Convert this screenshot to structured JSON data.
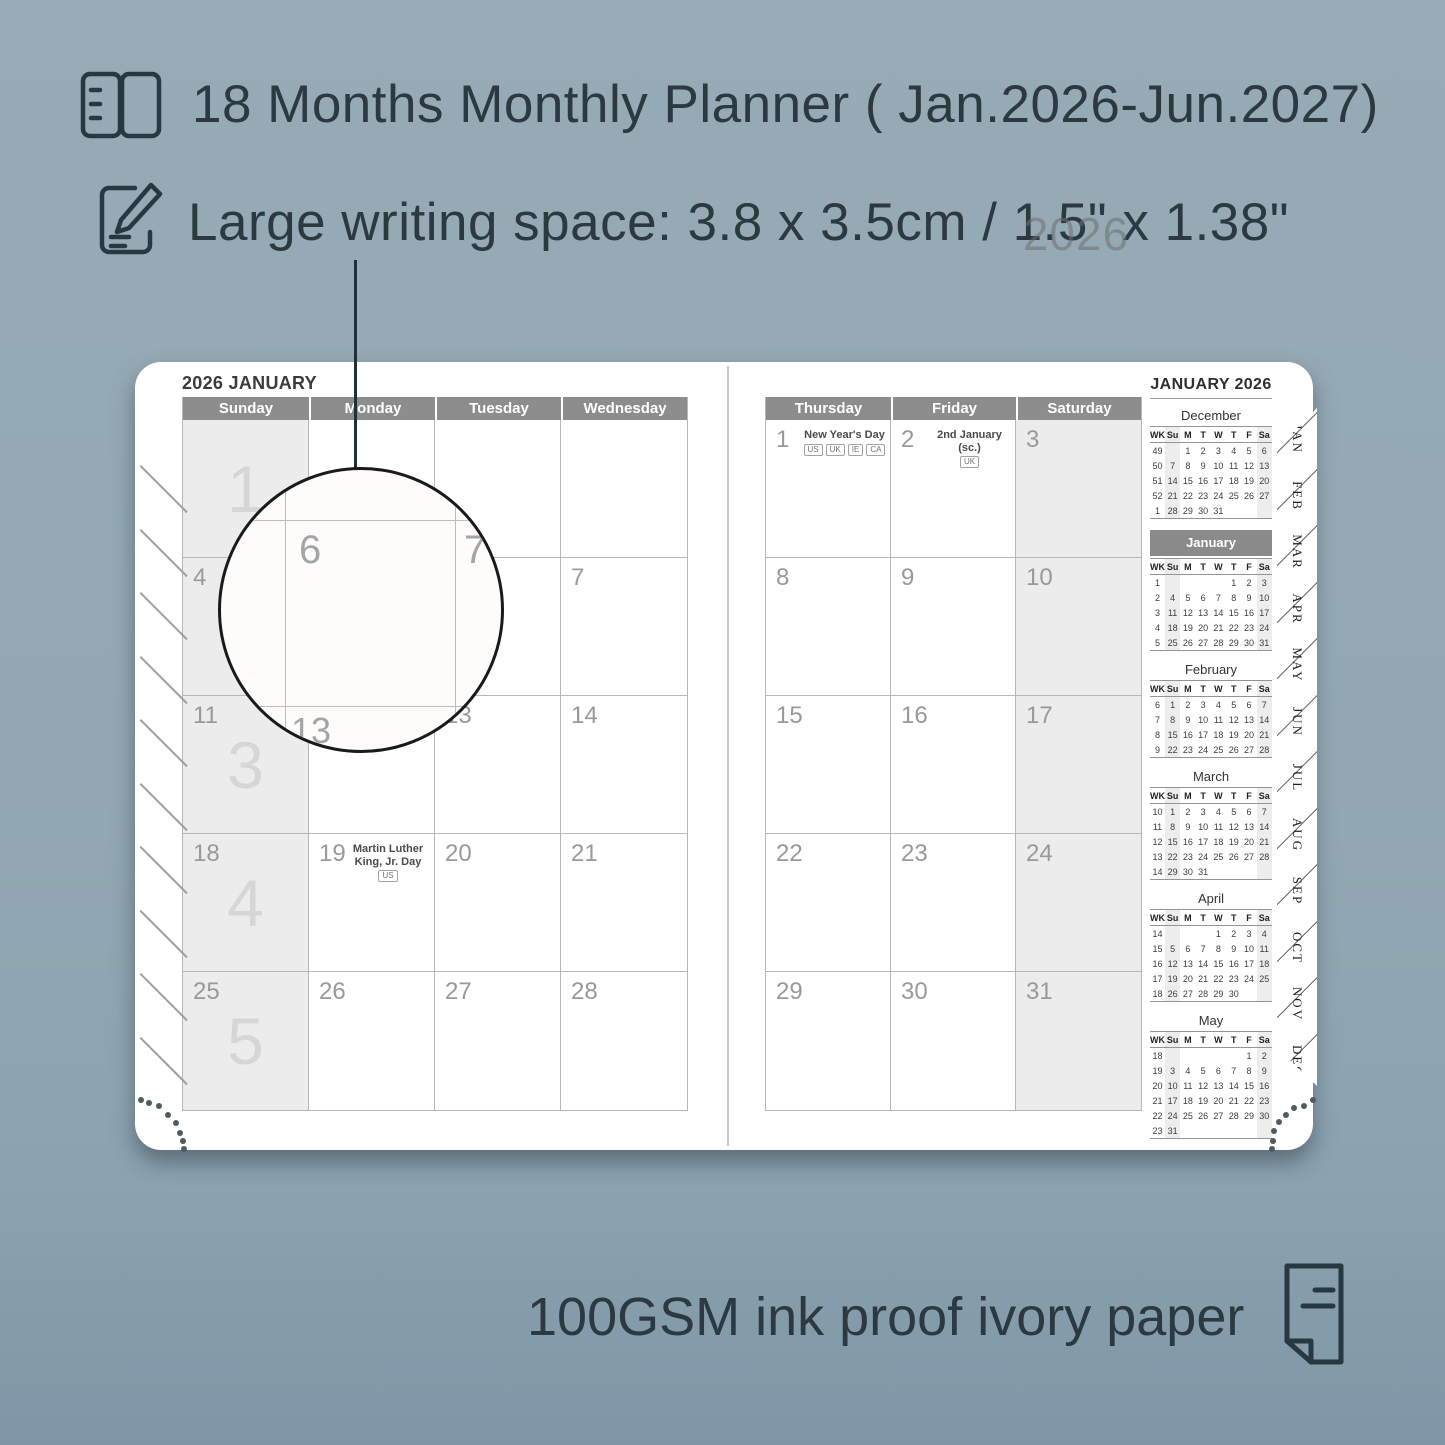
{
  "colors": {
    "background": "#93a8b3",
    "accent_text": "#2c3941",
    "header_bar": "#8d8d8d",
    "shaded_column": "#ececec",
    "banner": "#8a8a8a"
  },
  "features": {
    "planner_range": "18 Months Monthly Planner ( Jan.2026-Jun.2027)",
    "writing_space": "Large writing space: 3.8 x 3.5cm / 1.5\" x 1.38\"",
    "paper": "100GSM ink proof ivory paper"
  },
  "magnifier": {
    "main_cell": "6",
    "right_cell": "7",
    "below_cell": "13"
  },
  "planner": {
    "left_page": {
      "title": "2026 JANUARY",
      "day_headers": [
        "Sunday",
        "Monday",
        "Tuesday",
        "Wednesday"
      ],
      "rows": [
        {
          "week_big": "1",
          "cells": [
            {
              "date": ""
            },
            {
              "date": ""
            },
            {
              "date": ""
            },
            {
              "date": ""
            }
          ]
        },
        {
          "week_big": "2",
          "cells": [
            {
              "date": "4"
            },
            {
              "date": "5"
            },
            {
              "date": "6"
            },
            {
              "date": "7"
            }
          ]
        },
        {
          "week_big": "3",
          "cells": [
            {
              "date": "11"
            },
            {
              "date": "12"
            },
            {
              "date": "13"
            },
            {
              "date": "14"
            }
          ]
        },
        {
          "week_big": "4",
          "cells": [
            {
              "date": "18"
            },
            {
              "date": "19",
              "holiday": "Martin Luther King, Jr. Day",
              "badges": [
                "US"
              ]
            },
            {
              "date": "20"
            },
            {
              "date": "21"
            }
          ]
        },
        {
          "week_big": "5",
          "cells": [
            {
              "date": "25"
            },
            {
              "date": "26"
            },
            {
              "date": "27"
            },
            {
              "date": "28"
            }
          ]
        }
      ]
    },
    "right_page": {
      "day_headers": [
        "Thursday",
        "Friday",
        "Saturday"
      ],
      "rows": [
        {
          "cells": [
            {
              "date": "1",
              "holiday": "New Year's Day",
              "badges": [
                "US",
                "UK",
                "IE",
                "CA"
              ]
            },
            {
              "date": "2",
              "holiday": "2nd January (sc.)",
              "badges": [
                "UK"
              ]
            },
            {
              "date": "3"
            }
          ]
        },
        {
          "cells": [
            {
              "date": "8"
            },
            {
              "date": "9"
            },
            {
              "date": "10"
            }
          ]
        },
        {
          "cells": [
            {
              "date": "15"
            },
            {
              "date": "16"
            },
            {
              "date": "17"
            }
          ]
        },
        {
          "cells": [
            {
              "date": "22"
            },
            {
              "date": "23"
            },
            {
              "date": "24"
            }
          ]
        },
        {
          "cells": [
            {
              "date": "29"
            },
            {
              "date": "30"
            },
            {
              "date": "31"
            }
          ]
        }
      ]
    },
    "sidebar": {
      "title": "JANUARY 2026",
      "watermark": "2026",
      "weekday_headers": [
        "WK",
        "Su",
        "M",
        "T",
        "W",
        "T",
        "F",
        "Sa"
      ],
      "months": [
        {
          "name": "December",
          "highlight": false,
          "rows": [
            {
              "wk": "49",
              "days": [
                "",
                "1",
                "2",
                "3",
                "4",
                "5",
                "6"
              ]
            },
            {
              "wk": "50",
              "days": [
                "7",
                "8",
                "9",
                "10",
                "11",
                "12",
                "13"
              ]
            },
            {
              "wk": "51",
              "days": [
                "14",
                "15",
                "16",
                "17",
                "18",
                "19",
                "20"
              ]
            },
            {
              "wk": "52",
              "days": [
                "21",
                "22",
                "23",
                "24",
                "25",
                "26",
                "27"
              ]
            },
            {
              "wk": "1",
              "days": [
                "28",
                "29",
                "30",
                "31",
                "",
                "",
                ""
              ]
            }
          ]
        },
        {
          "name": "January",
          "highlight": true,
          "rows": [
            {
              "wk": "1",
              "days": [
                "",
                "",
                "",
                "",
                "1",
                "2",
                "3"
              ]
            },
            {
              "wk": "2",
              "days": [
                "4",
                "5",
                "6",
                "7",
                "8",
                "9",
                "10"
              ]
            },
            {
              "wk": "3",
              "days": [
                "11",
                "12",
                "13",
                "14",
                "15",
                "16",
                "17"
              ]
            },
            {
              "wk": "4",
              "days": [
                "18",
                "19",
                "20",
                "21",
                "22",
                "23",
                "24"
              ]
            },
            {
              "wk": "5",
              "days": [
                "25",
                "26",
                "27",
                "28",
                "29",
                "30",
                "31"
              ]
            }
          ]
        },
        {
          "name": "February",
          "highlight": false,
          "rows": [
            {
              "wk": "6",
              "days": [
                "1",
                "2",
                "3",
                "4",
                "5",
                "6",
                "7"
              ]
            },
            {
              "wk": "7",
              "days": [
                "8",
                "9",
                "10",
                "11",
                "12",
                "13",
                "14"
              ]
            },
            {
              "wk": "8",
              "days": [
                "15",
                "16",
                "17",
                "18",
                "19",
                "20",
                "21"
              ]
            },
            {
              "wk": "9",
              "days": [
                "22",
                "23",
                "24",
                "25",
                "26",
                "27",
                "28"
              ]
            }
          ]
        },
        {
          "name": "March",
          "highlight": false,
          "rows": [
            {
              "wk": "10",
              "days": [
                "1",
                "2",
                "3",
                "4",
                "5",
                "6",
                "7"
              ]
            },
            {
              "wk": "11",
              "days": [
                "8",
                "9",
                "10",
                "11",
                "12",
                "13",
                "14"
              ]
            },
            {
              "wk": "12",
              "days": [
                "15",
                "16",
                "17",
                "18",
                "19",
                "20",
                "21"
              ]
            },
            {
              "wk": "13",
              "days": [
                "22",
                "23",
                "24",
                "25",
                "26",
                "27",
                "28"
              ]
            },
            {
              "wk": "14",
              "days": [
                "29",
                "30",
                "31",
                "",
                "",
                "",
                ""
              ]
            }
          ]
        },
        {
          "name": "April",
          "highlight": false,
          "rows": [
            {
              "wk": "14",
              "days": [
                "",
                "",
                "",
                "1",
                "2",
                "3",
                "4"
              ]
            },
            {
              "wk": "15",
              "days": [
                "5",
                "6",
                "7",
                "8",
                "9",
                "10",
                "11"
              ]
            },
            {
              "wk": "16",
              "days": [
                "12",
                "13",
                "14",
                "15",
                "16",
                "17",
                "18"
              ]
            },
            {
              "wk": "17",
              "days": [
                "19",
                "20",
                "21",
                "22",
                "23",
                "24",
                "25"
              ]
            },
            {
              "wk": "18",
              "days": [
                "26",
                "27",
                "28",
                "29",
                "30",
                "",
                ""
              ]
            }
          ]
        },
        {
          "name": "May",
          "highlight": false,
          "rows": [
            {
              "wk": "18",
              "days": [
                "",
                "",
                "",
                "",
                "",
                "1",
                "2"
              ]
            },
            {
              "wk": "19",
              "days": [
                "3",
                "4",
                "5",
                "6",
                "7",
                "8",
                "9"
              ]
            },
            {
              "wk": "20",
              "days": [
                "10",
                "11",
                "12",
                "13",
                "14",
                "15",
                "16"
              ]
            },
            {
              "wk": "21",
              "days": [
                "17",
                "18",
                "19",
                "20",
                "21",
                "22",
                "23"
              ]
            },
            {
              "wk": "22",
              "days": [
                "24",
                "25",
                "26",
                "27",
                "28",
                "29",
                "30"
              ]
            },
            {
              "wk": "23",
              "days": [
                "31",
                "",
                "",
                "",
                "",
                "",
                ""
              ]
            }
          ]
        }
      ]
    },
    "tabs": [
      "JAN",
      "FEB",
      "MAR",
      "APR",
      "MAY",
      "JUN",
      "JUL",
      "AUG",
      "SEP",
      "OCT",
      "NOV",
      "DEC"
    ]
  }
}
